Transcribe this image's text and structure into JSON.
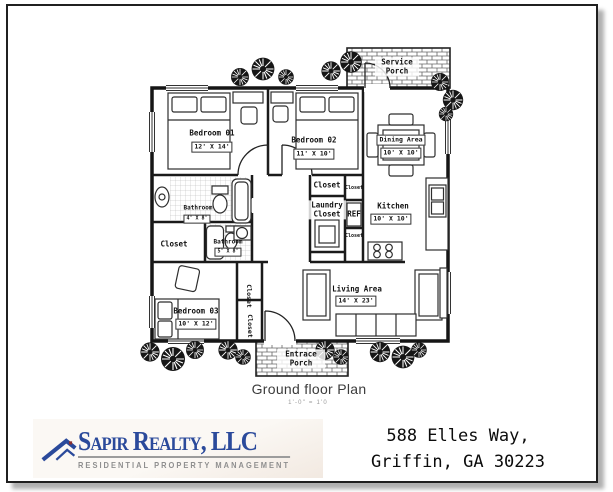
{
  "page": {
    "plan_title": "Ground floor Plan",
    "plan_scale": "1'-0\" = 1'0"
  },
  "plan": {
    "rooms": {
      "bedroom1": {
        "name": "Bedroom 01",
        "dims": "12' X 14'"
      },
      "bedroom2": {
        "name": "Bedroom 02",
        "dims": "11' X 10'"
      },
      "bedroom3": {
        "name": "Bedroom 03",
        "dims": "10' X 12'"
      },
      "dining": {
        "name": "Dining Area",
        "dims": "10' X 10'"
      },
      "kitchen": {
        "name": "Kitchen",
        "dims": "10' X 10'"
      },
      "living": {
        "name": "Living Area",
        "dims": "14' X 23'"
      },
      "bathroom1": {
        "name": "Bathroom",
        "dims": "4' X 8'"
      },
      "bathroom2": {
        "name": "Bathroom",
        "dims": "5' X 8'"
      }
    },
    "labels": {
      "closet": "Closet",
      "laundry_closet": "Laundry Closet",
      "ref": "REF",
      "service_porch": "Service Porch",
      "entrance_porch": "Entrace Porch"
    }
  },
  "branding": {
    "company": "Sapir Realty, LLC",
    "tagline": "RESIDENTIAL PROPERTY MANAGEMENT",
    "brand_blue": "#2b4a9b",
    "accent_red": "#8b2f2f"
  },
  "address": {
    "line1": "588 Elles Way,",
    "line2": "Griffin, GA 30223"
  }
}
